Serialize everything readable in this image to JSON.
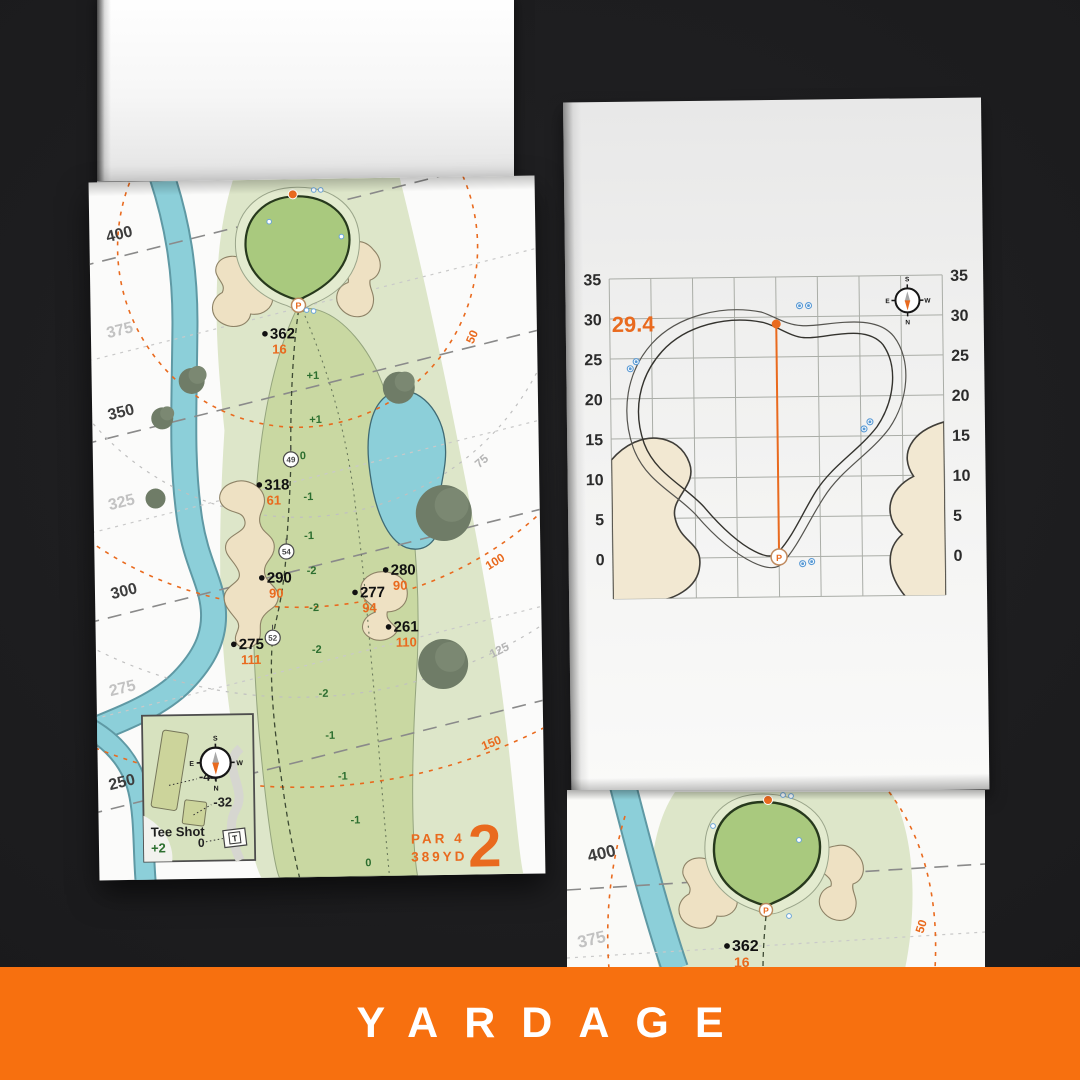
{
  "banner": {
    "label": "YARDAGE"
  },
  "colors": {
    "accent_orange": "#e96a1e",
    "banner_orange": "#f7700f",
    "elevation_green": "#2c6e2f",
    "water_blue": "#8ccfd9",
    "sand_tan": "#eee1c3",
    "green_fill": "#a9c97e",
    "fairway_green": "#c9d8a2",
    "rough_green": "#dde6c9"
  },
  "left_page": {
    "hole": {
      "number": "2",
      "par": "PAR 4",
      "yards": "389YD"
    },
    "distance_labels": [
      {
        "value": "400",
        "shade": "dark"
      },
      {
        "value": "375",
        "shade": "light"
      },
      {
        "value": "350",
        "shade": "dark"
      },
      {
        "value": "325",
        "shade": "light"
      },
      {
        "value": "300",
        "shade": "dark"
      },
      {
        "value": "275",
        "shade": "light"
      },
      {
        "value": "250",
        "shade": "dark"
      }
    ],
    "arc_labels": [
      {
        "value": "50",
        "tone": "orange"
      },
      {
        "value": "75",
        "tone": "gray"
      },
      {
        "value": "100",
        "tone": "orange"
      },
      {
        "value": "125",
        "tone": "gray"
      },
      {
        "value": "150",
        "tone": "orange"
      }
    ],
    "markers": [
      {
        "primary": "362",
        "secondary": "16"
      },
      {
        "primary": "318",
        "secondary": "61"
      },
      {
        "primary": "290",
        "secondary": "90"
      },
      {
        "primary": "280",
        "secondary": "90"
      },
      {
        "primary": "277",
        "secondary": "94"
      },
      {
        "primary": "261",
        "secondary": "110"
      },
      {
        "primary": "275",
        "secondary": "111"
      }
    ],
    "waypoints": [
      "49",
      "54",
      "52"
    ],
    "elevations": [
      "+1",
      "+1",
      "0",
      "-1",
      "-1",
      "-2",
      "-2",
      "-2",
      "-2",
      "-1",
      "-1",
      "-1",
      "0"
    ],
    "tee_inset": {
      "title": "Tee Shot",
      "strokes_gained": "+2",
      "zero": "0",
      "offsets": [
        "-44",
        "-32"
      ],
      "tee_marker": "T"
    },
    "compass": {
      "n": "N",
      "s": "S",
      "e": "E",
      "w": "W"
    },
    "pin_letter": "P"
  },
  "right_page": {
    "green_chart": {
      "type": "map-grid",
      "y_ticks": [
        "35",
        "30",
        "25",
        "20",
        "15",
        "10",
        "5",
        "0"
      ],
      "depth_to_pin": "29.4",
      "pin_letter": "P",
      "compass": {
        "n": "N",
        "s": "S",
        "e": "E",
        "w": "W"
      }
    }
  },
  "bottom_page": {
    "distance_labels": [
      "400",
      "375"
    ],
    "marker": {
      "primary": "362",
      "secondary": "16"
    },
    "arc_label": "50",
    "pin_letter": "P"
  }
}
